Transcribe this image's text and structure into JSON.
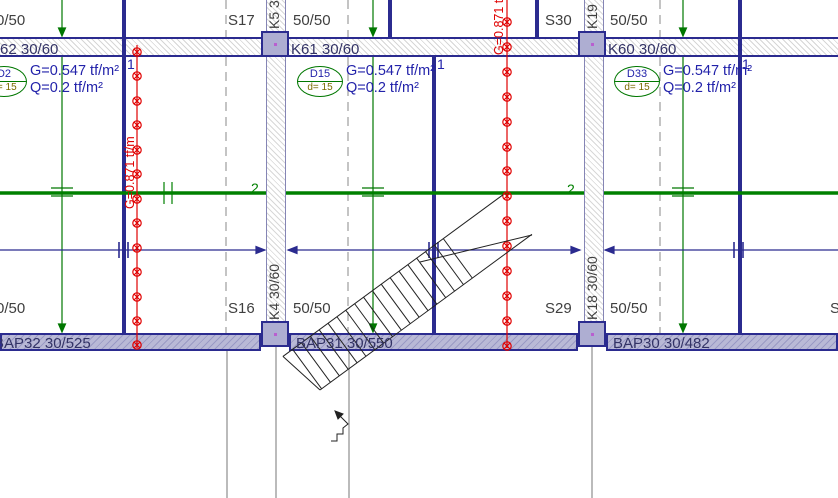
{
  "drawing": {
    "grid_row_top": {
      "edge_dim": "0/50",
      "s17": "S17",
      "k5": "K5 30/60",
      "dim1": "50/50",
      "s30": "S30",
      "k19": "K19",
      "dim2": "50/50"
    },
    "beams_top": {
      "b_left": "62 30/60",
      "b_mid": "K61 30/60",
      "b_right": "K60 30/60"
    },
    "slab_loads": [
      {
        "id": "D2",
        "thickness": "d= 15",
        "g": "G=0.547 tf/m²",
        "q": "Q=0.2 tf/m²"
      },
      {
        "id": "D15",
        "thickness": "d= 15",
        "g": "G=0.547 tf/m²",
        "q": "Q=0.2 tf/m²"
      },
      {
        "id": "D33",
        "thickness": "d= 15",
        "g": "G=0.547 tf/m²",
        "q": "Q=0.2 tf/m²"
      }
    ],
    "line_loads": {
      "left": "G=0.871 tf/m",
      "right": "G=0.871 tf/m"
    },
    "strip_markers": {
      "dir1": "1",
      "dir2": "2"
    },
    "grid_row_bottom": {
      "edge_dim": "0/50",
      "s16": "S16",
      "k4": "K4 30/60",
      "dim1": "50/50",
      "s29": "S29",
      "k18": "K18 30/60",
      "dim2": "50/50",
      "edge_col": "S"
    },
    "beams_bottom": {
      "b_left": "BAP32 30/525",
      "b_mid": "BAP31 30/550",
      "b_right": "BAP30 30/482"
    },
    "colors": {
      "beam_outline": "#2b2b8f",
      "strip_dir1": "#2b2b8f",
      "strip_dir2": "#008000",
      "line_load": "#e00000",
      "column_fill": "#aeaed2",
      "beam_fill_bottom": "#b9b9d6",
      "label_gray": "#3f3f3f",
      "label_navy": "#333366",
      "load_text": "#2222aa",
      "thickness_text": "#7a6a00"
    }
  }
}
